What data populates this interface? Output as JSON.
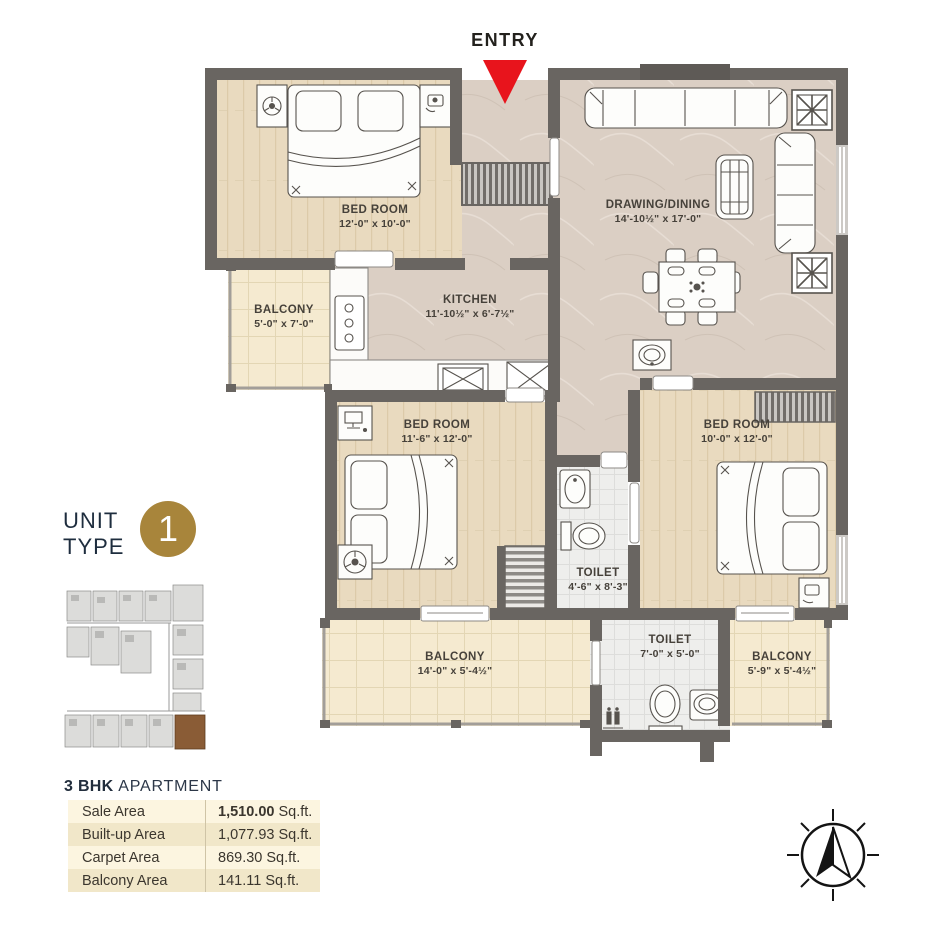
{
  "entry": {
    "label": "ENTRY"
  },
  "unit_type": {
    "word1": "UNIT",
    "word2": "TYPE",
    "number": "1"
  },
  "rooms": [
    {
      "name": "BED ROOM",
      "dims": "12'-0\" x 10'-0\""
    },
    {
      "name": "DRAWING/DINING",
      "dims": "14'-10½\" x 17'-0\""
    },
    {
      "name": "KITCHEN",
      "dims": "11'-10½\" x 6'-7½\""
    },
    {
      "name": "BALCONY",
      "dims": "5'-0\" x 7'-0\""
    },
    {
      "name": "BED ROOM",
      "dims": "11'-6\" x 12'-0\""
    },
    {
      "name": "BED ROOM",
      "dims": "10'-0\" x 12'-0\""
    },
    {
      "name": "TOILET",
      "dims": "4'-6\" x 8'-3\""
    },
    {
      "name": "TOILET",
      "dims": "7'-0\" x 5'-0\""
    },
    {
      "name": "BALCONY",
      "dims": "14'-0\" x 5'-4½\""
    },
    {
      "name": "BALCONY",
      "dims": "5'-9\" x 5'-4½\""
    }
  ],
  "apartment": {
    "title_bold": "3 BHK",
    "title_light": "APARTMENT",
    "rows": [
      {
        "label": "Sale Area",
        "number": "1,510.00",
        "unit": "Sq.ft."
      },
      {
        "label": "Built-up Area",
        "number": "1,077.93",
        "unit": "Sq.ft."
      },
      {
        "label": "Carpet Area",
        "number": "869.30",
        "unit": "Sq.ft."
      },
      {
        "label": "Balcony Area",
        "number": "141.11",
        "unit": "Sq.ft."
      }
    ]
  },
  "colors": {
    "accent_gold": "#a8853b",
    "entry_red": "#e8141c",
    "wall_gray": "#696561",
    "navy_text": "#1e2d3e"
  }
}
